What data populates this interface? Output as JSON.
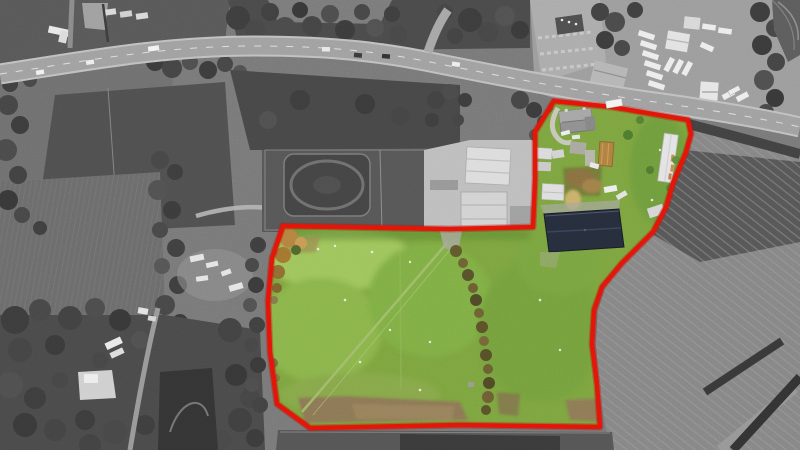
{
  "image": {
    "kind": "aerial-photograph",
    "description": "Drone aerial photograph of a smallholding: site outlined in red, land inside the boundary shown in colour, surroundings desaturated to black and white",
    "width_px": 800,
    "height_px": 450
  },
  "palette": {
    "boundary_red": "#e31508",
    "boundary_red_soft": "#b01008",
    "grass_base": "#7ca43f",
    "grass_light": "#9ec45c",
    "grass_mid": "#8ab44b",
    "grass_dark": "#6f9c3c",
    "worn_earth": "#8c7754",
    "worn_earth_light": "#97815b",
    "autumn_tree": "#b5823f",
    "hedgerow_olive": "#60592c",
    "barn_roof_navy": "#262d3b",
    "rusty_roof": "#b07f41",
    "shed_white": "#dcdcdc",
    "bw_base": "#787878",
    "bw_field": "#747474",
    "bw_dark_field": "#4f4f4f",
    "bw_trees": "#424242",
    "bw_road": "#a0a0a0",
    "bw_yard": "#bdbdbd",
    "bw_plowed": "#858585",
    "bw_track_dark": "#3a3a3a"
  },
  "site": {
    "outline_points": "554,101 612,107 688,120 691,134 686,152 673,183 666,207 653,232 622,263 602,287 594,310 592,344 597,385 600,427 460,425 310,428 277,404 270,352 268,300 272,258 283,226 450,229 533,227 535,180 535,132",
    "features": [
      "farmhouse",
      "farm outbuildings",
      "dark navy-roofed barn",
      "long white shed",
      "rusty-roof building",
      "muck heap",
      "grass pasture",
      "diagonal field track",
      "hedgerow of bushes",
      "autumn-coloured trees",
      "worn brown ground"
    ]
  },
  "surroundings": {
    "features": [
      "main road with traffic",
      "side road junction",
      "caravan storage yard",
      "car park",
      "neighbouring farmyard with white sheds",
      "horse paddocks and riding arena",
      "ploughed field",
      "woodland",
      "hedgerows",
      "pond",
      "farm tracks",
      "white caravans"
    ]
  }
}
